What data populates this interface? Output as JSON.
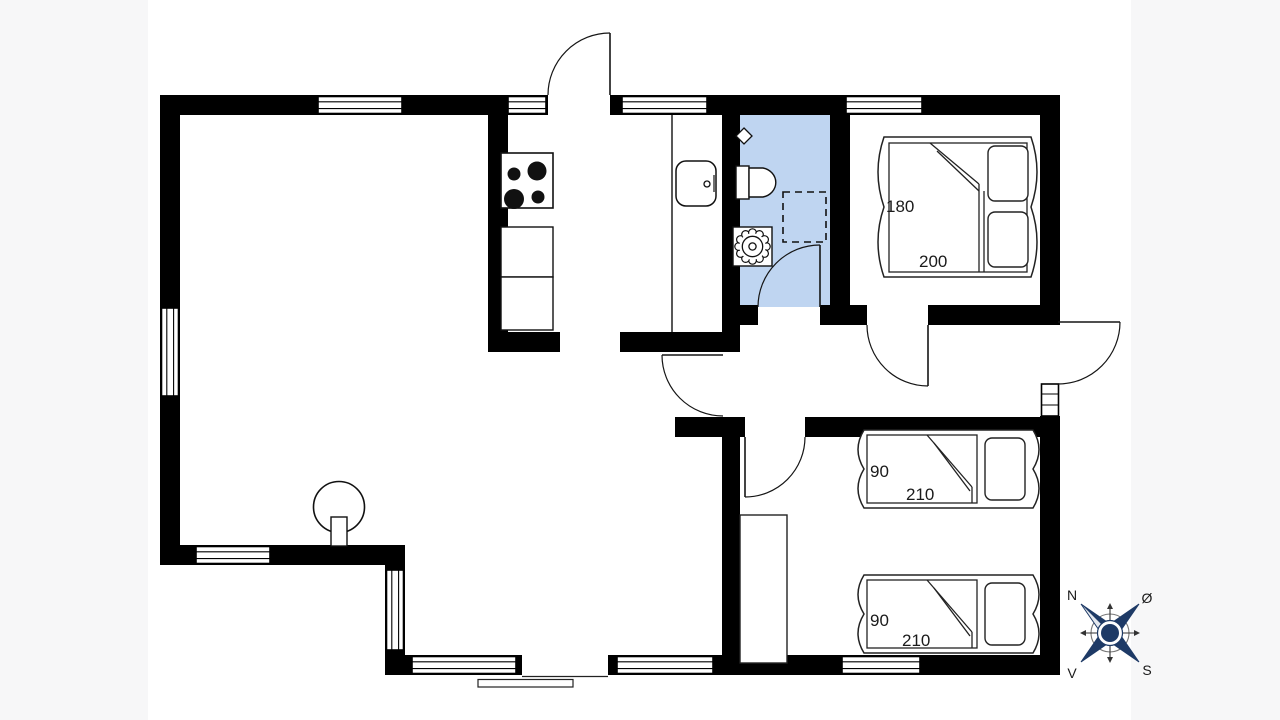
{
  "labels": {
    "bedroom_double": {
      "width": "180",
      "length": "200"
    },
    "bed_single_top": {
      "width": "90",
      "length": "210"
    },
    "bed_single_bottom": {
      "width": "90",
      "length": "210"
    }
  },
  "compass": {
    "north": "N",
    "east": "Ø",
    "west": "V",
    "south": "S"
  },
  "colors": {
    "wall": "#000000",
    "bathroom_fill": "#bfd5f1",
    "compass_navy": "#1e3a66"
  }
}
